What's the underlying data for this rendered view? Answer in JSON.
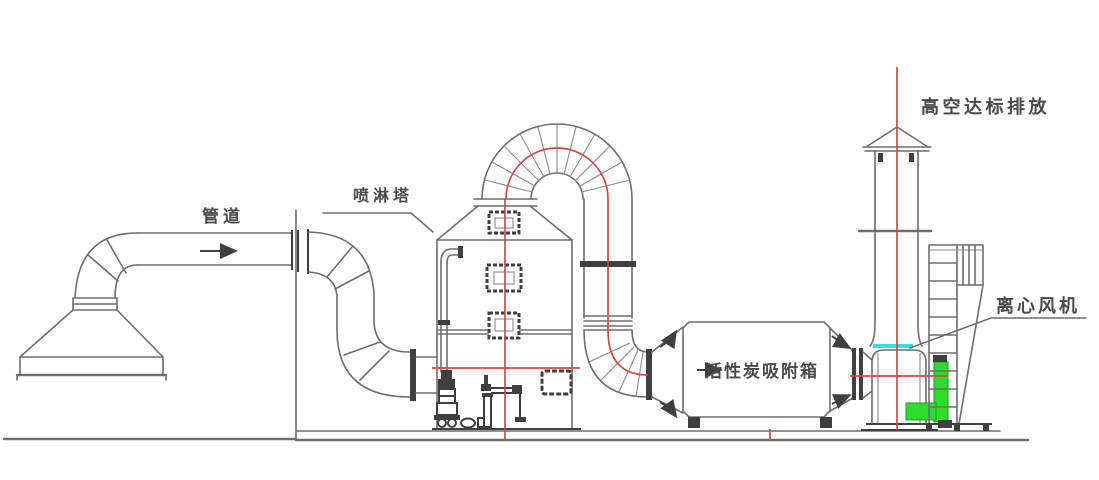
{
  "diagram": {
    "type": "engineering-schematic",
    "subject": "waste-gas-treatment-system-side-view",
    "labels": {
      "duct": "管道",
      "spray_tower": "喷淋塔",
      "carbon_box": "活性炭吸附箱",
      "fan": "离心风机",
      "emission": "高空达标排放"
    },
    "colors": {
      "line": "#6e6e6e",
      "dark": "#3f3f3f",
      "flow_path": "#cf4a4a",
      "inlet_highlight": "#3adce8",
      "motor_green": "#2edc2e",
      "label_text": "#4a4a4a",
      "background": "#ffffff"
    }
  }
}
